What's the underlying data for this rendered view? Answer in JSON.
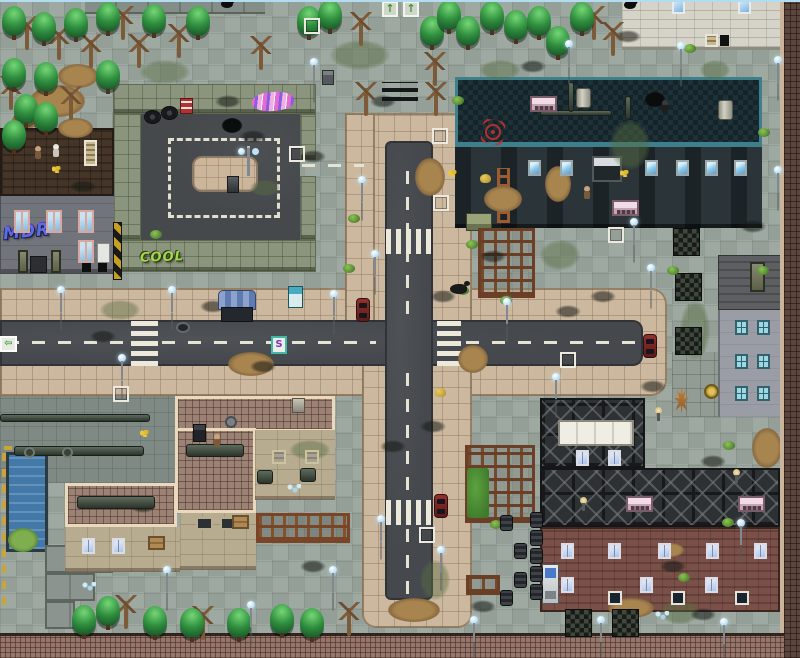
{
  "meta": {
    "width": 800,
    "height": 658,
    "description": "Top-down pixel-art post-apocalyptic city map (RPG-style): cross intersection of two asphalt roads with crosswalks, parking lot, lab building, ruined apartment blocks, warehouse with girder roof, brick house, pool, trees and street lamps."
  },
  "palette": {
    "pavement": "#9aa59d",
    "sidewalk": "#ccb89f",
    "asphalt": "#45494d",
    "road_line": "#e6e2d4",
    "lab_teal": "#3f7f8c",
    "brick_wall": "#5c453c",
    "brick_house": "#7a5048",
    "roof_tile": "#9c8274",
    "parking_wall": "#8b947c",
    "water": "#4379a8",
    "girder": "#2e3134",
    "tree_green": "#2f8f3f",
    "graffiti_blue": "#5b6ee1",
    "graffiti_green": "#a4d74e",
    "hazard_yellow": "#c8a020"
  },
  "graffiti": {
    "mdr": "MDR",
    "cool": "COOL"
  },
  "icons": {
    "up_arrow": "↑",
    "left_arrow": "⇦",
    "pink_graffiti": "scribble",
    "red_graffiti": "scribble"
  },
  "signs": {
    "s_label": "S"
  },
  "sprites": {
    "pines": [
      [
        2,
        6
      ],
      [
        32,
        12
      ],
      [
        64,
        8
      ],
      [
        96,
        2
      ],
      [
        142,
        4
      ],
      [
        186,
        6
      ],
      [
        2,
        58
      ],
      [
        34,
        62
      ],
      [
        96,
        60
      ],
      [
        14,
        94
      ],
      [
        34,
        102
      ],
      [
        2,
        120
      ],
      [
        297,
        6
      ],
      [
        318,
        0
      ],
      [
        420,
        16
      ],
      [
        437,
        0
      ],
      [
        456,
        16
      ],
      [
        480,
        1
      ],
      [
        504,
        10
      ],
      [
        527,
        6
      ],
      [
        546,
        26
      ],
      [
        570,
        2
      ],
      [
        72,
        605
      ],
      [
        96,
        596
      ],
      [
        143,
        606
      ],
      [
        180,
        608
      ],
      [
        227,
        608
      ],
      [
        270,
        604
      ],
      [
        300,
        608
      ]
    ],
    "dead_trees": [
      [
        16,
        16
      ],
      [
        48,
        26
      ],
      [
        80,
        34
      ],
      [
        112,
        6
      ],
      [
        128,
        34
      ],
      [
        168,
        24
      ],
      [
        60,
        86
      ],
      [
        0,
        76
      ],
      [
        250,
        36
      ],
      [
        350,
        12
      ],
      [
        424,
        52
      ],
      [
        355,
        82
      ],
      [
        425,
        82
      ],
      [
        583,
        6
      ],
      [
        602,
        22
      ],
      [
        115,
        595
      ],
      [
        192,
        606
      ],
      [
        338,
        602
      ]
    ],
    "lamps": [
      [
        310,
        58
      ],
      [
        565,
        40
      ],
      [
        677,
        42
      ],
      [
        774,
        56
      ],
      [
        774,
        166
      ],
      [
        358,
        176
      ],
      [
        371,
        250
      ],
      [
        57,
        286
      ],
      [
        168,
        286
      ],
      [
        330,
        290
      ],
      [
        503,
        298
      ],
      [
        118,
        354
      ],
      [
        163,
        566
      ],
      [
        247,
        601
      ],
      [
        329,
        566
      ],
      [
        377,
        515
      ],
      [
        437,
        546
      ],
      [
        470,
        616
      ],
      [
        597,
        616
      ],
      [
        720,
        618
      ],
      [
        630,
        218
      ],
      [
        647,
        264
      ],
      [
        552,
        373
      ],
      [
        737,
        519
      ]
    ],
    "markers": [
      [
        304,
        18
      ],
      [
        289,
        146
      ],
      [
        432,
        128
      ],
      [
        433,
        195
      ],
      [
        113,
        386
      ],
      [
        560,
        352
      ],
      [
        608,
        227
      ],
      [
        419,
        527
      ]
    ],
    "cars": [
      [
        356,
        298
      ],
      [
        643,
        334
      ],
      [
        434,
        494
      ]
    ],
    "bushes": [
      [
        348,
        214
      ],
      [
        452,
        96
      ],
      [
        150,
        230
      ],
      [
        457,
        286
      ],
      [
        500,
        296
      ],
      [
        667,
        266
      ],
      [
        723,
        441
      ],
      [
        678,
        573
      ],
      [
        684,
        44
      ],
      [
        758,
        128
      ],
      [
        757,
        266
      ],
      [
        722,
        518
      ],
      [
        343,
        264
      ],
      [
        490,
        520
      ],
      [
        466,
        240
      ]
    ],
    "flowers": [
      [
        52,
        166
      ],
      [
        140,
        430
      ],
      [
        620,
        170
      ],
      [
        448,
        170
      ]
    ],
    "stains": [
      [
        215,
        95
      ],
      [
        240,
        130
      ],
      [
        370,
        95
      ],
      [
        300,
        150
      ],
      [
        480,
        250
      ],
      [
        590,
        290
      ],
      [
        640,
        380
      ],
      [
        200,
        300
      ],
      [
        90,
        330
      ],
      [
        430,
        290
      ],
      [
        380,
        440
      ],
      [
        300,
        560
      ],
      [
        660,
        560
      ],
      [
        700,
        455
      ],
      [
        555,
        305
      ],
      [
        130,
        500
      ],
      [
        470,
        600
      ],
      [
        615,
        30
      ],
      [
        70,
        180
      ],
      [
        250,
        360
      ],
      [
        420,
        420
      ],
      [
        740,
        220
      ],
      [
        210,
        445
      ],
      [
        520,
        60
      ],
      [
        690,
        608
      ]
    ],
    "holes": [
      [
        645,
        92
      ],
      [
        222,
        118
      ]
    ],
    "dirt_patches": [
      [
        30,
        85,
        55,
        32
      ],
      [
        58,
        118,
        35,
        20
      ],
      [
        228,
        352,
        46,
        24
      ],
      [
        484,
        186,
        38,
        26
      ],
      [
        608,
        598,
        46,
        20
      ],
      [
        388,
        598,
        52,
        24
      ],
      [
        752,
        428,
        30,
        40
      ],
      [
        658,
        543,
        26,
        14
      ],
      [
        415,
        158,
        30,
        38
      ],
      [
        58,
        64,
        40,
        24
      ],
      [
        12,
        112,
        30,
        16
      ],
      [
        458,
        345,
        30,
        28
      ],
      [
        545,
        166,
        26,
        36
      ]
    ],
    "moss": [
      [
        330,
        40,
        60,
        30
      ],
      [
        140,
        60,
        50,
        24
      ],
      [
        480,
        60,
        40,
        20
      ],
      [
        610,
        120,
        40,
        50
      ],
      [
        680,
        300,
        30,
        60
      ],
      [
        540,
        240,
        40,
        30
      ],
      [
        290,
        440,
        40,
        20
      ],
      [
        420,
        560,
        30,
        40
      ],
      [
        660,
        600,
        40,
        24
      ],
      [
        100,
        300,
        40,
        20
      ],
      [
        250,
        180,
        30,
        16
      ],
      [
        700,
        60,
        30,
        20
      ]
    ],
    "barrels": [
      [
        530,
        512
      ],
      [
        530,
        530
      ],
      [
        530,
        548
      ],
      [
        530,
        566
      ],
      [
        530,
        584
      ],
      [
        500,
        515
      ],
      [
        514,
        543
      ],
      [
        514,
        572
      ],
      [
        500,
        590
      ]
    ],
    "mats": [
      [
        673,
        228
      ],
      [
        675,
        273
      ],
      [
        675,
        327
      ],
      [
        565,
        609
      ],
      [
        612,
        609
      ]
    ],
    "figures_white": [
      [
        52,
        144
      ]
    ],
    "figures_brown": [
      [
        34,
        146
      ],
      [
        213,
        434
      ],
      [
        583,
        186
      ]
    ],
    "figures_dark": [
      [
        661,
        100
      ]
    ],
    "dogs": [
      [
        450,
        284
      ]
    ],
    "crows": [
      [
        624,
        1
      ],
      [
        221,
        0
      ]
    ],
    "chicks": [
      [
        480,
        174
      ],
      [
        435,
        388
      ]
    ],
    "crystals": [
      [
        655,
        611
      ],
      [
        287,
        484
      ],
      [
        82,
        582
      ]
    ],
    "valves": [
      [
        24,
        447
      ],
      [
        62,
        447
      ]
    ],
    "consoles": [
      [
        530,
        96
      ],
      [
        612,
        200
      ],
      [
        626,
        496
      ],
      [
        738,
        496
      ]
    ],
    "tanks": [
      [
        576,
        88
      ],
      [
        718,
        100
      ]
    ],
    "girder_lamps": [
      [
        580,
        497
      ],
      [
        733,
        469
      ],
      [
        655,
        407
      ]
    ],
    "tires": [
      [
        144,
        110
      ],
      [
        161,
        106
      ]
    ],
    "pipes": [
      [
        540,
        110,
        72,
        6
      ],
      [
        568,
        82,
        6,
        30
      ],
      [
        625,
        96,
        6,
        24
      ],
      [
        0,
        414,
        150,
        8
      ],
      [
        14,
        446,
        130,
        10
      ],
      [
        186,
        444,
        58,
        13
      ],
      [
        77,
        496,
        78,
        13
      ],
      [
        257,
        470,
        16,
        14
      ],
      [
        300,
        468,
        16,
        14
      ]
    ],
    "up_arrows": [
      [
        382,
        1
      ],
      [
        403,
        1
      ]
    ],
    "left_arrows": [
      [
        0,
        336
      ]
    ],
    "s_signs": [
      [
        271,
        336
      ]
    ],
    "lab_windows": [
      [
        528,
        160
      ],
      [
        560,
        160
      ],
      [
        645,
        160
      ],
      [
        676,
        160
      ],
      [
        705,
        160
      ],
      [
        734,
        160
      ]
    ],
    "white_windows": [
      [
        672,
        0
      ],
      [
        738,
        0
      ]
    ],
    "left_windows": [
      [
        14,
        210
      ],
      [
        46,
        210
      ],
      [
        78,
        210
      ],
      [
        78,
        240
      ]
    ],
    "gray_windows": [
      [
        735,
        320
      ],
      [
        757,
        320
      ],
      [
        735,
        354
      ],
      [
        757,
        354
      ],
      [
        735,
        386
      ],
      [
        757,
        386
      ]
    ],
    "house_windows_r1": [
      [
        561,
        543
      ],
      [
        608,
        543
      ],
      [
        658,
        543
      ],
      [
        706,
        543
      ],
      [
        754,
        543
      ]
    ],
    "house_windows_r2": [
      [
        561,
        577
      ],
      [
        640,
        577
      ],
      [
        705,
        577
      ]
    ],
    "house_signs": [
      [
        608,
        591
      ],
      [
        671,
        591
      ],
      [
        735,
        591
      ]
    ],
    "girder_windows": [
      [
        576,
        450
      ],
      [
        608,
        450
      ]
    ],
    "wallA_windows": [
      [
        272,
        450
      ],
      [
        305,
        450
      ]
    ],
    "wallA2_windows": [
      [
        196,
        517
      ],
      [
        220,
        517
      ]
    ],
    "wallC_windows": [
      [
        82,
        538
      ],
      [
        112,
        538
      ]
    ],
    "boarded_windows": [
      [
        148,
        536
      ],
      [
        232,
        515
      ]
    ]
  }
}
